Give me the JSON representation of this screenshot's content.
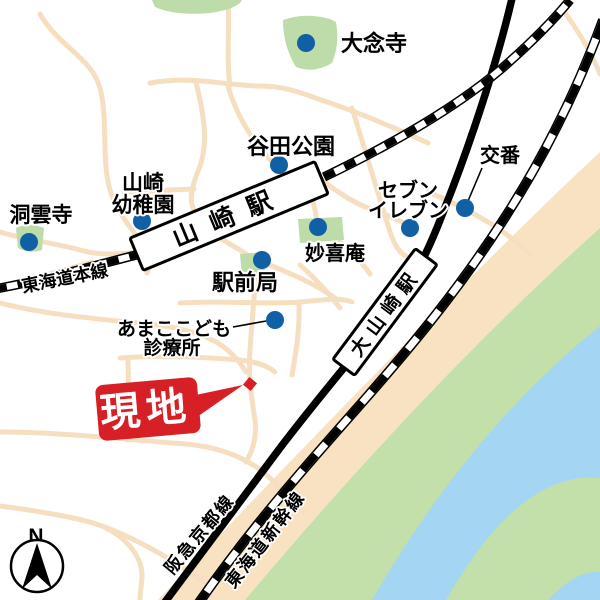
{
  "colors": {
    "marker_blue": "#1160a6",
    "site_red": "#d71f26",
    "road_peach": "#f6dfc0",
    "facility_green": "#bedbaa",
    "riverbank_green": "#c3dfaa",
    "river_blue": "#a4d5f3",
    "embankment_peach": "#f8e2c2",
    "rail_black": "#000000",
    "station_fill": "#ffffff"
  },
  "labels": {
    "dainenji": "大念寺",
    "yatada_park": "谷田公園",
    "kindergarten_l1": "山崎",
    "kindergarten_l2": "幼稚園",
    "dounji": "洞雲寺",
    "yamazaki_station": "山崎駅",
    "tokaido_main_line": "東海道本線",
    "myokian": "妙喜庵",
    "seven_l1": "セブン",
    "seven_l2": "イレブン",
    "koban": "交番",
    "ekimae_post": "駅前局",
    "clinic_l1": "あまここども",
    "clinic_l2": "診療所",
    "oyamazaki_station": "大山崎駅",
    "genchi": "現地",
    "hankyu_kyoto_line": "阪急京都線",
    "tokaido_shinkansen": "東海道新幹線"
  },
  "compass": {
    "north": "N"
  }
}
